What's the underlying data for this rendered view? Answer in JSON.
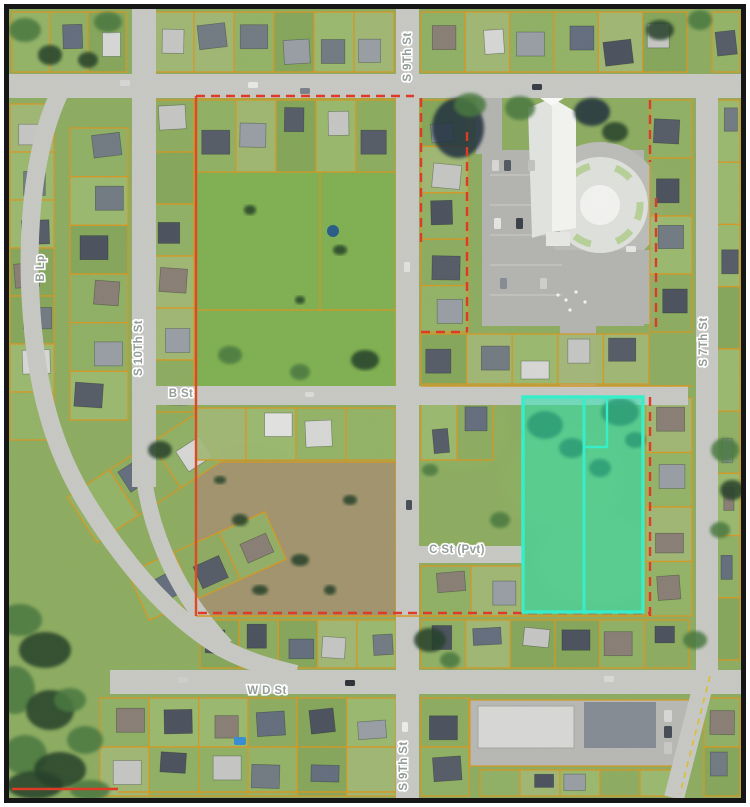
{
  "figure": {
    "type": "aerial-parcel-map",
    "frame_color": "#161616",
    "page_background": "#ffffff"
  },
  "map": {
    "labels": {
      "s9th_north": "S 9Th St",
      "s9th_south": "S 9Th St",
      "s10th": "S 10Th St",
      "s7th": "S 7Th St",
      "b_lp": "B Lp",
      "b_st": "B St",
      "c_st": "C St (Pvt)",
      "w_d_st": "W D St"
    },
    "colors": {
      "parcel_line": "#d79a26",
      "boundary_line": "#e03b28",
      "highlight_fill": "#2fe8b7",
      "highlight_stroke": "#36f2cd",
      "road": "#c9cac5",
      "grass": "#8fae63",
      "label_text": "#939c97",
      "label_halo": "#ffffff"
    },
    "highlight": {
      "name": "highlighted-parcels",
      "parcel_count": 2
    }
  }
}
